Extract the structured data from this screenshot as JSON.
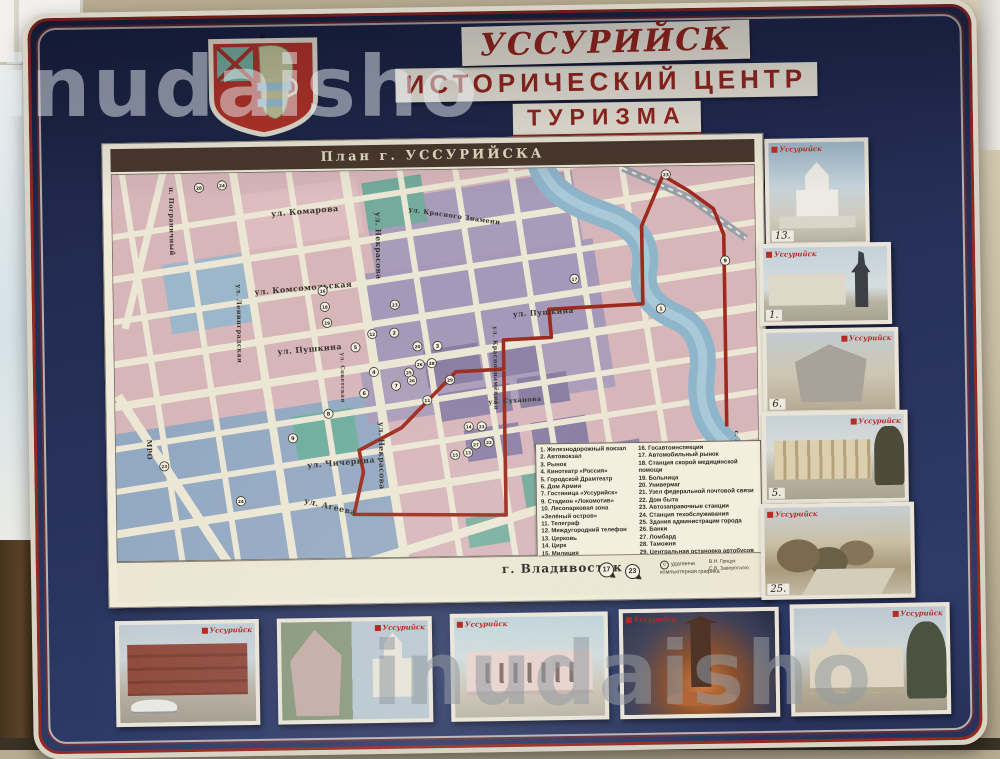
{
  "watermark": {
    "text": "inudaisho"
  },
  "board": {
    "title_line1": "УССУРИЙСК",
    "title_line2": "ИСТОРИЧЕСКИЙ ЦЕНТР",
    "title_line3": "ТУРИЗМА"
  },
  "map": {
    "panel_title": "План  г. УССУРИЙСКА",
    "top_label": "г. Хабаровск,  Арсеньев",
    "bottom_label": "г. Владивосток",
    "bottom_markers": [
      "17",
      "23"
    ],
    "copyright_symbol": "c",
    "copyright_line1": "удалянчи",
    "copyright_line2": "компьютерная графика",
    "credit_line1": "В.Н. Грицук",
    "credit_line2": "С.В. Заворотного",
    "route_color": "#9e2a1e",
    "streets": [
      {
        "t": "п. Пограничный",
        "x": 66,
        "y": 44,
        "v": 1,
        "s": 6.5
      },
      {
        "t": "ул. Комарова",
        "x": 168,
        "y": 75,
        "r": -4,
        "s": 8
      },
      {
        "t": "ул. Красного Знамени",
        "x": 305,
        "y": 72,
        "r": 9,
        "s": 6.5
      },
      {
        "t": "ул. Некрасова",
        "x": 272,
        "y": 72,
        "v": 1,
        "s": 7.5
      },
      {
        "t": "ул. Комсомольская",
        "x": 150,
        "y": 153,
        "r": -4,
        "s": 8
      },
      {
        "t": "ул. Пушкина",
        "x": 172,
        "y": 213,
        "r": -4,
        "s": 8
      },
      {
        "t": "ул. Пушкина",
        "x": 408,
        "y": 179,
        "r": -3,
        "s": 7.5
      },
      {
        "t": "ул. Ленинградская",
        "x": 132,
        "y": 142,
        "v": 1,
        "s": 6.5
      },
      {
        "t": "ул. Советская",
        "x": 235,
        "y": 212,
        "v": 1,
        "s": 5.5
      },
      {
        "t": "ул. Некрасова",
        "x": 272,
        "y": 282,
        "v": 1,
        "s": 7.5
      },
      {
        "t": "ул. Краснознамённая",
        "x": 388,
        "y": 188,
        "v": 1,
        "s": 6
      },
      {
        "t": "ул. Суханова",
        "x": 382,
        "y": 266,
        "r": -3,
        "s": 6.5
      },
      {
        "t": "ул. Чичерина",
        "x": 200,
        "y": 327,
        "r": -4,
        "s": 8
      },
      {
        "t": "ул. Агеева",
        "x": 196,
        "y": 362,
        "r": 14,
        "s": 8
      },
      {
        "t": "с. Раковка,  Заповедник",
        "x": 628,
        "y": 296,
        "v": 1,
        "s": 6
      },
      {
        "t": "МРО",
        "x": 40,
        "y": 296,
        "v": 1,
        "s": 7
      }
    ],
    "markers": [
      {
        "n": "28",
        "x": 96,
        "y": 45
      },
      {
        "n": "24",
        "x": 119,
        "y": 43
      },
      {
        "n": "16",
        "x": 218,
        "y": 150
      },
      {
        "n": "18",
        "x": 220,
        "y": 166
      },
      {
        "n": "19",
        "x": 222,
        "y": 182
      },
      {
        "n": "23",
        "x": 563,
        "y": 39
      },
      {
        "n": "9",
        "x": 621,
        "y": 126
      },
      {
        "n": "1",
        "x": 556,
        "y": 173
      },
      {
        "n": "23",
        "x": 290,
        "y": 165
      },
      {
        "n": "12",
        "x": 267,
        "y": 194
      },
      {
        "n": "2",
        "x": 289,
        "y": 193
      },
      {
        "n": "4",
        "x": 268,
        "y": 232
      },
      {
        "n": "25",
        "x": 303,
        "y": 233
      },
      {
        "n": "26",
        "x": 314,
        "y": 225
      },
      {
        "n": "28",
        "x": 326,
        "y": 224
      },
      {
        "n": "7",
        "x": 290,
        "y": 246
      },
      {
        "n": "26",
        "x": 306,
        "y": 241
      },
      {
        "n": "29",
        "x": 344,
        "y": 241
      },
      {
        "n": "3",
        "x": 332,
        "y": 207
      },
      {
        "n": "20",
        "x": 312,
        "y": 207
      },
      {
        "n": "5",
        "x": 250,
        "y": 207
      },
      {
        "n": "6",
        "x": 258,
        "y": 253
      },
      {
        "n": "11",
        "x": 321,
        "y": 261
      },
      {
        "n": "8",
        "x": 222,
        "y": 273
      },
      {
        "n": "9",
        "x": 186,
        "y": 297
      },
      {
        "n": "14",
        "x": 362,
        "y": 288
      },
      {
        "n": "21",
        "x": 375,
        "y": 288
      },
      {
        "n": "15",
        "x": 348,
        "y": 316
      },
      {
        "n": "13",
        "x": 361,
        "y": 314
      },
      {
        "n": "27",
        "x": 369,
        "y": 306
      },
      {
        "n": "22",
        "x": 382,
        "y": 304
      },
      {
        "n": "10",
        "x": 497,
        "y": 368
      },
      {
        "n": "24",
        "x": 133,
        "y": 359
      },
      {
        "n": "23",
        "x": 57,
        "y": 323
      },
      {
        "n": "17",
        "x": 470,
        "y": 142
      }
    ]
  },
  "legend": {
    "left": [
      "1.  Железнодорожный вокзал",
      "2.  Автовокзал",
      "3.  Рынок",
      "4.  Кинотеатр «Россия»",
      "5.  Городской Драмтеатр",
      "6.  Дом Армии",
      "7.  Гостиница «Уссурийск»",
      "9.  Стадион «Локомотив»",
      "10. Лесопарковая зона «Зелёный остров»",
      "11. Телеграф",
      "12. Междугородний телефон",
      "13. Церковь",
      "14. Цирк",
      "15. Милиция"
    ],
    "right": [
      "16. Госавтоинспекция",
      "17. Автомобильный рынок",
      "18. Станция скорой медицинской помощи",
      "19. Больница",
      "20. Универмаг",
      "21. Узел федеральной почтовой связи",
      "22. Дом быта",
      "23. Автозаправочные станции",
      "24. Станция техобслуживания",
      "25. Здания администрации города",
      "26. Банки",
      "27. Ломбард",
      "28. Таможня",
      "29. Центральная остановка автобусов"
    ]
  },
  "photos": {
    "right": [
      {
        "logo": "Уссурийск",
        "number": "13."
      },
      {
        "logo": "Уссурийск",
        "number": "1."
      },
      {
        "logo": "Уссурийск",
        "number": "6."
      },
      {
        "logo": "Уссурийск",
        "number": "5."
      },
      {
        "logo": "Уссурийск",
        "number": "25."
      }
    ],
    "bottom": [
      {
        "logo": "Уссурийск"
      },
      {
        "logo": "Уссурийск"
      },
      {
        "logo": "Уссурийск"
      },
      {
        "logo": "Уссурийск"
      },
      {
        "logo": "Уссурийск"
      }
    ]
  }
}
